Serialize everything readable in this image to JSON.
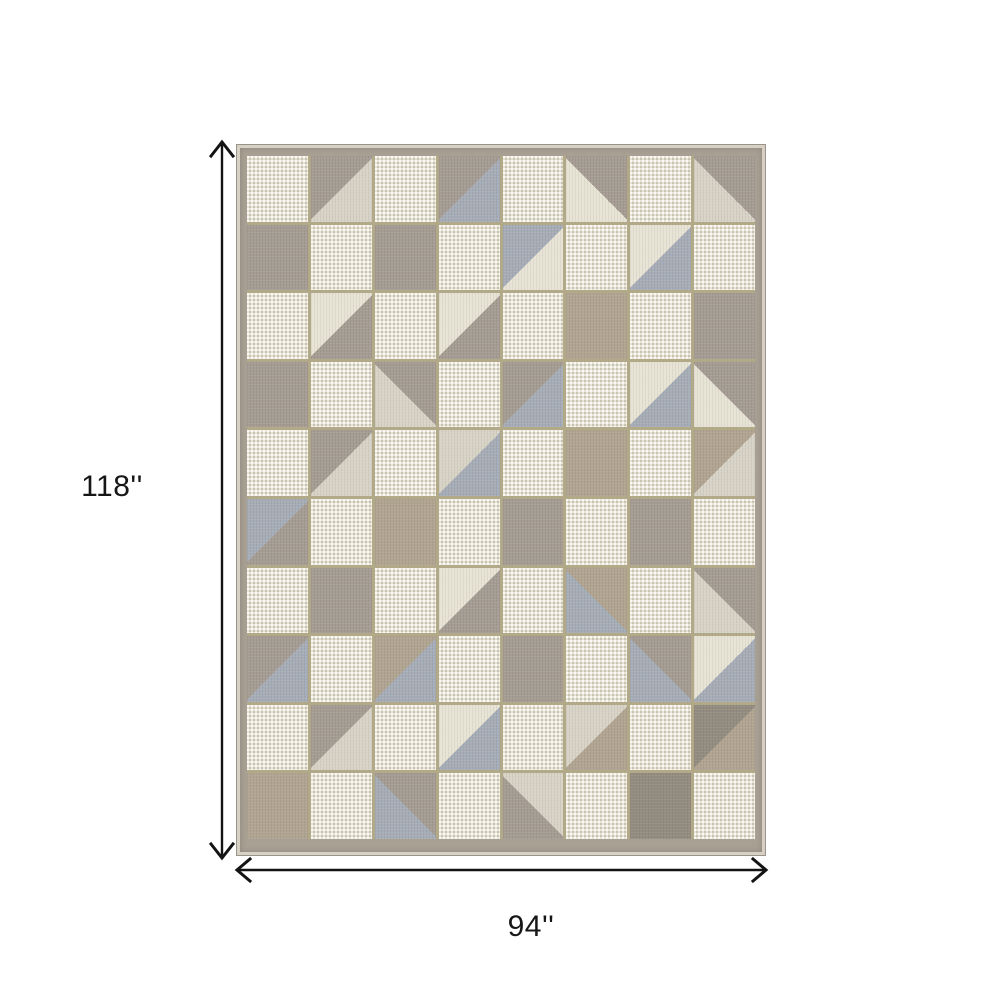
{
  "page": {
    "background": "#ffffff",
    "kind": "product dimension diagram"
  },
  "dimensions": {
    "height_label": "118''",
    "width_label": "94''",
    "arrow_color": "#141414",
    "text_color": "#161616"
  },
  "rug": {
    "description": "geometric patchwork area rug, checkerboard of cream flatweave and taupe/gray/blue-gray plush squares with diagonal triangle squares",
    "colors": {
      "c": "#e7e3d5",
      "g": "#a59d93",
      "t": "#b1a491",
      "b": "#a7adb6",
      "l": "#d8d3c6",
      "d": "#948c81",
      "gap": "#b1a987",
      "border": "#a9a094",
      "selvage": "#d6d1c4"
    },
    "legend": {
      "c": "cream flatweave (dotted texture)",
      "g": "gray-taupe plush",
      "t": "tan plush",
      "b": "blue-gray plush",
      "l": "light cream plush",
      "d": "dark gray plush",
      "X/Y": "square split along / diagonal: X upper-left, Y lower-right",
      "X\\Y": "square split along \\ diagonal: X upper-right, Y lower-left"
    },
    "grid": [
      [
        "c",
        "g/l",
        "c",
        "g/b",
        "c",
        "g\\c",
        "c",
        "g\\l"
      ],
      [
        "g",
        "c",
        "g",
        "c",
        "b/c",
        "c",
        "c/b",
        "c"
      ],
      [
        "c",
        "c/g",
        "c",
        "c/g",
        "c",
        "t",
        "c",
        "g"
      ],
      [
        "g",
        "c",
        "g\\l",
        "c",
        "g/b",
        "c",
        "c/b",
        "g\\c"
      ],
      [
        "c",
        "g/l",
        "c",
        "l/b",
        "c",
        "t",
        "c",
        "t/l"
      ],
      [
        "b/g",
        "c",
        "t",
        "c",
        "g",
        "c",
        "g",
        "c"
      ],
      [
        "c",
        "g",
        "c",
        "c/g",
        "c",
        "t\\b",
        "c",
        "g\\l"
      ],
      [
        "g/b",
        "c",
        "t/b",
        "c",
        "g",
        "c",
        "g\\b",
        "c/b"
      ],
      [
        "c",
        "g/l",
        "c",
        "c/b",
        "c",
        "l/t",
        "c",
        "d/t"
      ],
      [
        "t",
        "c",
        "g\\b",
        "c",
        "l\\g",
        "c",
        "d",
        "c"
      ]
    ]
  }
}
